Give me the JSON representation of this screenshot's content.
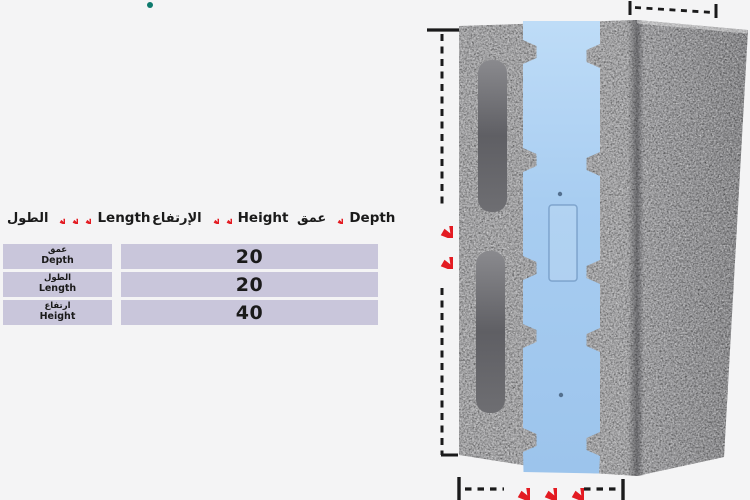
{
  "page": {
    "background": "#f4f4f5"
  },
  "colors": {
    "accent_red": "#e31b22",
    "table_cell_lavender": "#c9c6db",
    "teal_dot": "#0e7a6d",
    "text_dark": "#1a1a1a",
    "foam_blue": "#a8cdf1",
    "concrete_grey": "#a0a0a3"
  },
  "legend": {
    "items": [
      {
        "ar": "الطول",
        "en": "Length",
        "stars": 3
      },
      {
        "ar": "الإرتفاع",
        "en": "Height",
        "stars": 2
      },
      {
        "ar": "عمق",
        "en": "Depth",
        "stars": 1
      }
    ]
  },
  "spec_table": {
    "rows": [
      {
        "ar": "عمق",
        "en": "Depth",
        "value": "20"
      },
      {
        "ar": "الطول",
        "en": "Length",
        "value": "20"
      },
      {
        "ar": "ارتفاع",
        "en": "Height",
        "value": "40"
      }
    ]
  },
  "diagram": {
    "height_marker_stars": 2,
    "length_marker_stars": 3
  }
}
